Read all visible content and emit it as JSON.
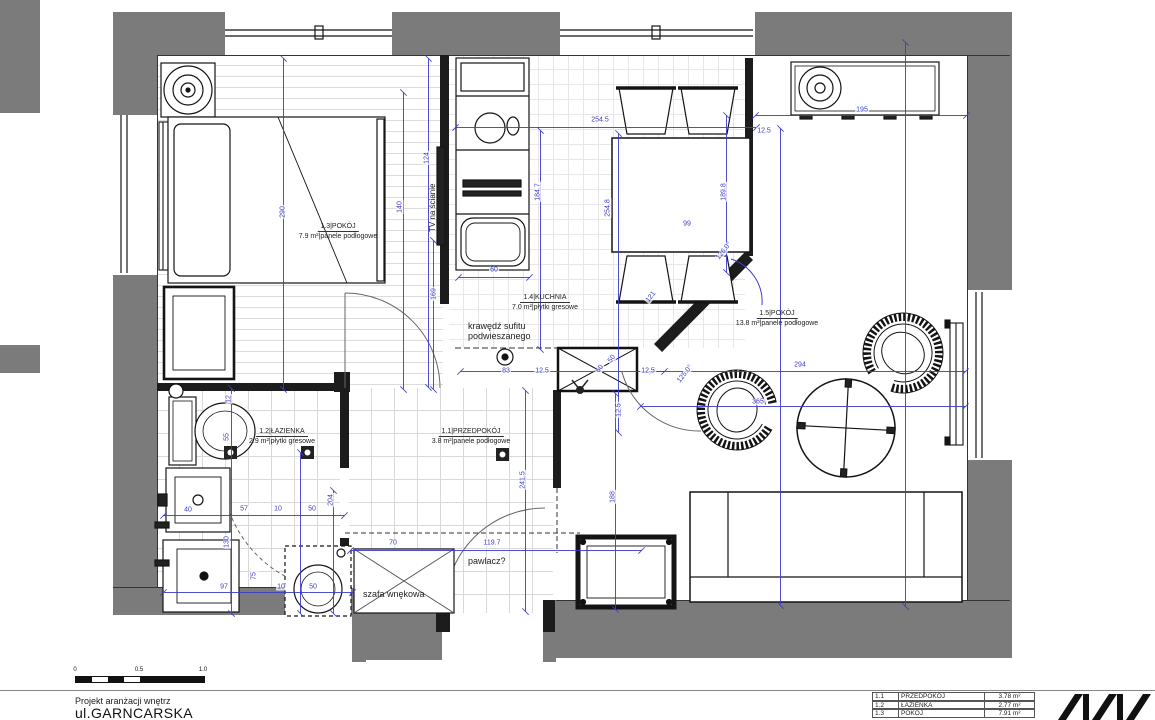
{
  "title_block": {
    "line1": "Projekt aranżacji wnętrz",
    "line2": "ul.GARNCARSKA"
  },
  "scalebar": {
    "labels": [
      "0",
      "0.5",
      "1.0"
    ]
  },
  "legend": {
    "rows": [
      [
        "1.1",
        "PRZEDPOKÓJ",
        "3.78 m²"
      ],
      [
        "1.2",
        "ŁAZIENKA",
        "2.77 m²"
      ],
      [
        "1.3",
        "POKÓJ",
        "7.91 m²"
      ]
    ]
  },
  "rooms": [
    {
      "id": "1.3",
      "name": "POKÓJ",
      "area": "7.9 m²",
      "floor": "panele podłogowe",
      "x": 338,
      "y": 222
    },
    {
      "id": "1.4",
      "name": "KUCHNIA",
      "area": "7.0 m²",
      "floor": "płytki gresowe",
      "x": 545,
      "y": 293
    },
    {
      "id": "1.5",
      "name": "POKÓJ",
      "area": "13.8 m²",
      "floor": "panele podłogowe",
      "x": 777,
      "y": 309
    },
    {
      "id": "1.2",
      "name": "ŁAZIENKA",
      "area": "2.9 m²",
      "floor": "płytki gresowe",
      "x": 282,
      "y": 427
    },
    {
      "id": "1.1",
      "name": "PRZEDPOKÓJ",
      "area": "3.8 m²",
      "floor": "panele podłogowe",
      "x": 471,
      "y": 427
    }
  ],
  "annotations": [
    {
      "text": "TV na ścianie",
      "x": 428,
      "y": 232,
      "rot": -90
    },
    {
      "text": "krawędź sufitu\npodwieszanego",
      "x": 468,
      "y": 321,
      "rot": 0
    },
    {
      "text": "pawlacz?",
      "x": 468,
      "y": 556,
      "rot": 0
    },
    {
      "text": "szafa wnękowa",
      "x": 363,
      "y": 589,
      "rot": 0
    }
  ],
  "dimensions": [
    [
      "254.5",
      600,
      120,
      0
    ],
    [
      "12.5",
      764,
      131,
      0
    ],
    [
      "195",
      862,
      110,
      0
    ],
    [
      "99",
      687,
      224,
      0
    ],
    [
      "60",
      494,
      270,
      0
    ],
    [
      "83",
      506,
      371,
      0
    ],
    [
      "12.5",
      542,
      371,
      0
    ],
    [
      "12.5",
      648,
      371,
      0
    ],
    [
      "294",
      800,
      365,
      0
    ],
    [
      "365",
      758,
      402,
      0
    ],
    [
      "57",
      244,
      509,
      0
    ],
    [
      "10",
      278,
      509,
      0
    ],
    [
      "50",
      312,
      509,
      0
    ],
    [
      "40",
      188,
      510,
      0
    ],
    [
      "97",
      224,
      587,
      0
    ],
    [
      "10",
      281,
      587,
      0
    ],
    [
      "50",
      313,
      587,
      0
    ],
    [
      "70",
      393,
      543,
      0
    ],
    [
      "119.7",
      492,
      543,
      0
    ],
    [
      "124",
      427,
      158,
      -90
    ],
    [
      "184.7",
      538,
      192,
      -90
    ],
    [
      "189.8",
      724,
      192,
      -90
    ],
    [
      "254.8",
      608,
      208,
      -90
    ],
    [
      "140",
      400,
      207,
      -90
    ],
    [
      "290",
      283,
      212,
      -90
    ],
    [
      "169",
      434,
      294,
      -90
    ],
    [
      "12.5",
      619,
      410,
      -90
    ],
    [
      "241.5",
      523,
      480,
      -90
    ],
    [
      "188",
      613,
      497,
      -90
    ],
    [
      "12",
      229,
      399,
      -90
    ],
    [
      "55",
      227,
      437,
      -90
    ],
    [
      "204",
      331,
      500,
      -90
    ],
    [
      "130",
      227,
      542,
      -90
    ],
    [
      "75",
      254,
      576,
      -90
    ],
    [
      "126.0°",
      724,
      251,
      -52
    ],
    [
      "125.0°",
      685,
      374,
      -52
    ],
    [
      "121",
      651,
      297,
      -52
    ],
    [
      "60",
      600,
      369,
      -52
    ],
    [
      "50",
      612,
      359,
      -52
    ]
  ],
  "dim_lines": {
    "h": [
      [
        455,
        127,
        302
      ],
      [
        755,
        115,
        212
      ],
      [
        458,
        277,
        72
      ],
      [
        460,
        371,
        205
      ],
      [
        652,
        371,
        314
      ],
      [
        640,
        406,
        326
      ],
      [
        350,
        550,
        292
      ],
      [
        163,
        515,
        182
      ],
      [
        163,
        592,
        190
      ]
    ],
    "v": [
      [
        428,
        58,
        330
      ],
      [
        540,
        130,
        220
      ],
      [
        726,
        115,
        158
      ],
      [
        618,
        133,
        300
      ],
      [
        283,
        58,
        332
      ],
      [
        403,
        92,
        298
      ],
      [
        433,
        240,
        150
      ],
      [
        525,
        390,
        222
      ],
      [
        615,
        393,
        217
      ],
      [
        780,
        128,
        478
      ],
      [
        905,
        42,
        565
      ],
      [
        231,
        388,
        226
      ],
      [
        300,
        452,
        162
      ],
      [
        333,
        490,
        124
      ]
    ]
  },
  "walls": [
    [
      0,
      0,
      40,
      113
    ],
    [
      0,
      345,
      40,
      28
    ],
    [
      113,
      12,
      112,
      43
    ],
    [
      392,
      12,
      168,
      43
    ],
    [
      755,
      12,
      257,
      43
    ],
    [
      113,
      12,
      44,
      103
    ],
    [
      113,
      275,
      44,
      337
    ],
    [
      113,
      588,
      245,
      27
    ],
    [
      352,
      600,
      14,
      62
    ],
    [
      543,
      600,
      13,
      62
    ],
    [
      352,
      613,
      90,
      47
    ],
    [
      556,
      600,
      456,
      58
    ],
    [
      968,
      55,
      44,
      235
    ],
    [
      968,
      460,
      44,
      198
    ]
  ],
  "colors": {
    "wall_gray": "#7b7b7b",
    "dimension_blue": "#3c3ccd",
    "drawing_ink": "#141414"
  }
}
